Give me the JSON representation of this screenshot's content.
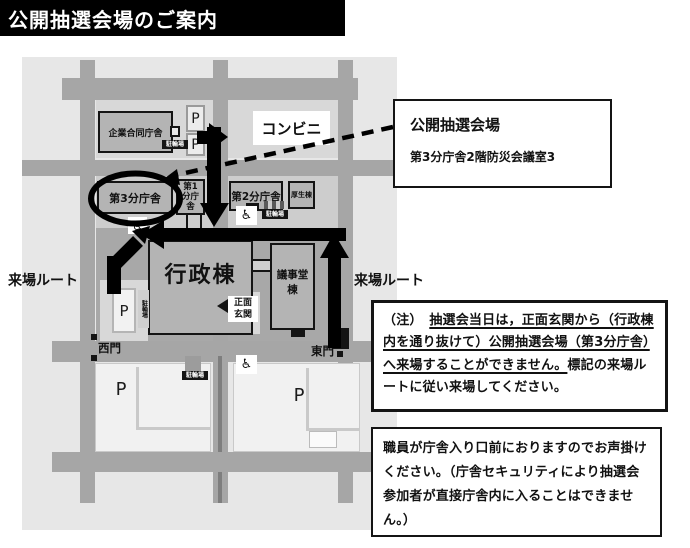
{
  "title_bar": {
    "title": "公開抽選会場のご案内"
  },
  "map": {
    "route_label": "来場ルート",
    "labels": {
      "corporate_joint_building": "企業合同庁舎",
      "convenience_store": "コンビニ",
      "annex_3": "第3分庁舎",
      "annex_1_line1": "第1",
      "annex_1_line2": "分庁舎",
      "annex_2": "第2分庁舎",
      "welfare_building": "厚生棟",
      "admin_building": "行政棟",
      "assembly_hall_building": "議事堂棟",
      "main_entrance_line1": "正面",
      "main_entrance_line2": "玄関",
      "west_gate": "西門",
      "east_gate": "東門",
      "parking": "P",
      "bicycle_parking": "駐輪場"
    },
    "icons": {
      "wheelchair": "♿"
    }
  },
  "callout": {
    "title": "公開抽選会場",
    "subtitle": "第3分庁舎2階防災会議室3"
  },
  "note_box": {
    "prefix": "（注）　",
    "underlined": "抽選会当日は，正面玄関から（行政棟内を通り抜けて）公開抽選会場（第3分庁舎）へ来場することができません。",
    "rest": "標記の来場ルートに従い来場してください。"
  },
  "staff_box": {
    "text": "職員が庁舎入り口前におりますのでお声掛けください。（庁舎セキュリティにより抽選会参加者が直接庁舎内に入ることはできません。）"
  },
  "colors": {
    "title_bar": "#000000",
    "map_background": "#e7e7e7",
    "road": "#a6a6a6",
    "building_fill": "#b4b4b4",
    "outline": "#141414",
    "route_arrow": "#000000"
  }
}
